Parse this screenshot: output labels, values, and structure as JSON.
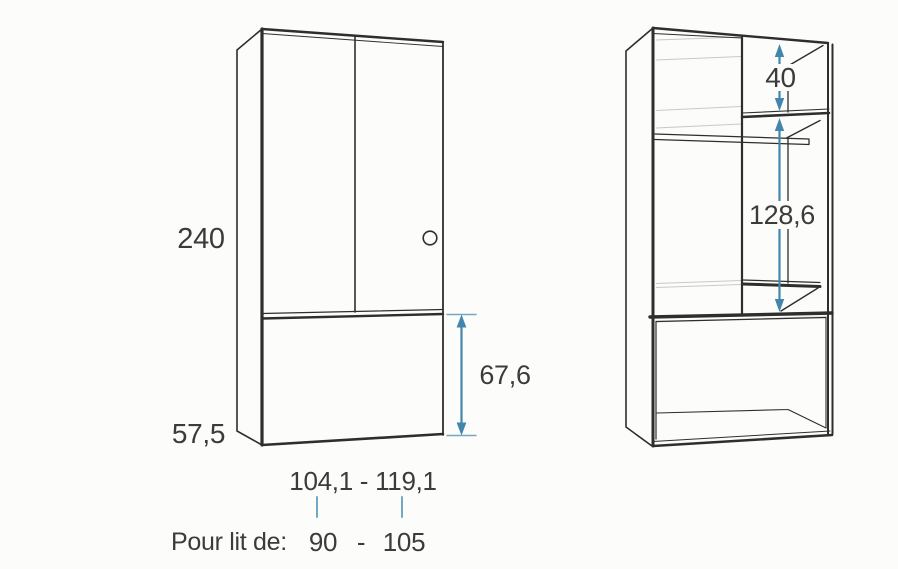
{
  "colors": {
    "line": "#2e2e2e",
    "faint_line": "#c9c9c9",
    "dimension_blue": "#4287ab",
    "tick_blue": "#72a7c5",
    "text": "#3b3b3b",
    "background": "#fcfcfb"
  },
  "front_view": {
    "labels": {
      "total_height": "240",
      "base_height": "57,5",
      "front_panel_height": "67,6",
      "width_range": "104,1 - 119,1"
    }
  },
  "interior_view": {
    "labels": {
      "top_compartment_height": "40",
      "interior_height": "128,6"
    }
  },
  "caption": {
    "label": "Pour lit de:",
    "min_width": "90",
    "separator": "-",
    "max_width": "105"
  }
}
